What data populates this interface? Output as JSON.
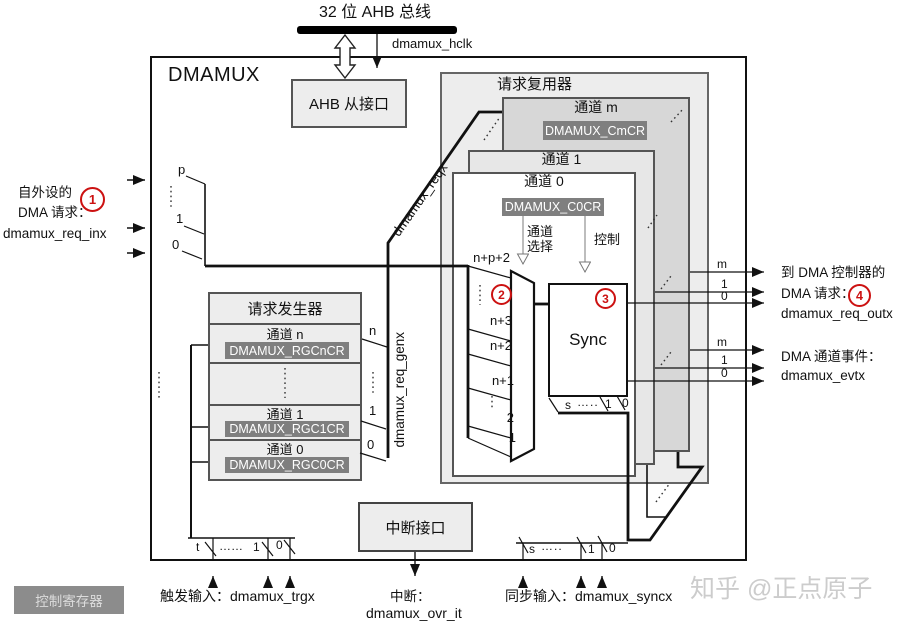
{
  "palette": {
    "accent_red": "#cc1111",
    "panel_gray": "#ededed",
    "channel_m_gray": "#d7d7d7",
    "channel_1_gray": "#e7e7e7",
    "register_gray": "#7f7f7f",
    "watermark_gray": "#cccccc"
  },
  "top": {
    "bus_title": "32 位 AHB 总线",
    "clk": "dmamux_hclk"
  },
  "main": {
    "title": "DMAMUX",
    "ahb": "AHB 从接口"
  },
  "mux": {
    "title": "请求复用器",
    "ch_m": "通道 m",
    "reg_m": "DMAMUX_CmCR",
    "ch_1": "通道 1",
    "ch_0": "通道 0",
    "reg_0": "DMAMUX_C0CR",
    "sel_line1": "通道",
    "sel_line2": "选择",
    "ctrl": "控制",
    "sync": "Sync",
    "badge_2": "2",
    "badge_3": "3",
    "inputs": [
      "n+p+2",
      "n+3",
      "n+2",
      "n+1",
      "2",
      "1"
    ],
    "mini_sel": {
      "s": "s",
      "dots": "…..",
      "one": "1",
      "zero": "0"
    }
  },
  "gen": {
    "title": "请求发生器",
    "rows": [
      [
        "通道 n",
        "DMAMUX_RGCnCR"
      ],
      [
        "通道 1",
        "DMAMUX_RGC1CR"
      ],
      [
        "通道 0",
        "DMAMUX_RGC0CR"
      ]
    ],
    "out": {
      "n": "n",
      "one": "1",
      "zero": "0"
    },
    "bus": "dmamux_req_genx"
  },
  "req_bus": "dmamux_reqx",
  "left": {
    "l1": "自外设的",
    "l2": "DMA 请求：",
    "l3": "dmamux_req_inx",
    "badge": "1",
    "p": "p",
    "one": "1",
    "zero": "0"
  },
  "right": {
    "r1": "到 DMA 控制器的",
    "r2": "DMA 请求：",
    "badge": "4",
    "r3": "dmamux_req_outx",
    "r4": "DMA 通道事件：",
    "r5": "dmamux_evtx",
    "m": "m",
    "one": "1",
    "zero": "0"
  },
  "bottom": {
    "trig": {
      "t": "t",
      "dots": "……",
      "one": "1",
      "zero": "0",
      "label": "触发输入：dmamux_trgx"
    },
    "irq": {
      "box": "中断接口",
      "l1": "中断：",
      "l2": "dmamux_ovr_it"
    },
    "sync": {
      "s": "s",
      "dots": "…..",
      "one": "1",
      "zero": "0",
      "label": "同步输入：dmamux_syncx"
    },
    "legend": "控制寄存器"
  },
  "watermark": "知乎 @正点原子"
}
